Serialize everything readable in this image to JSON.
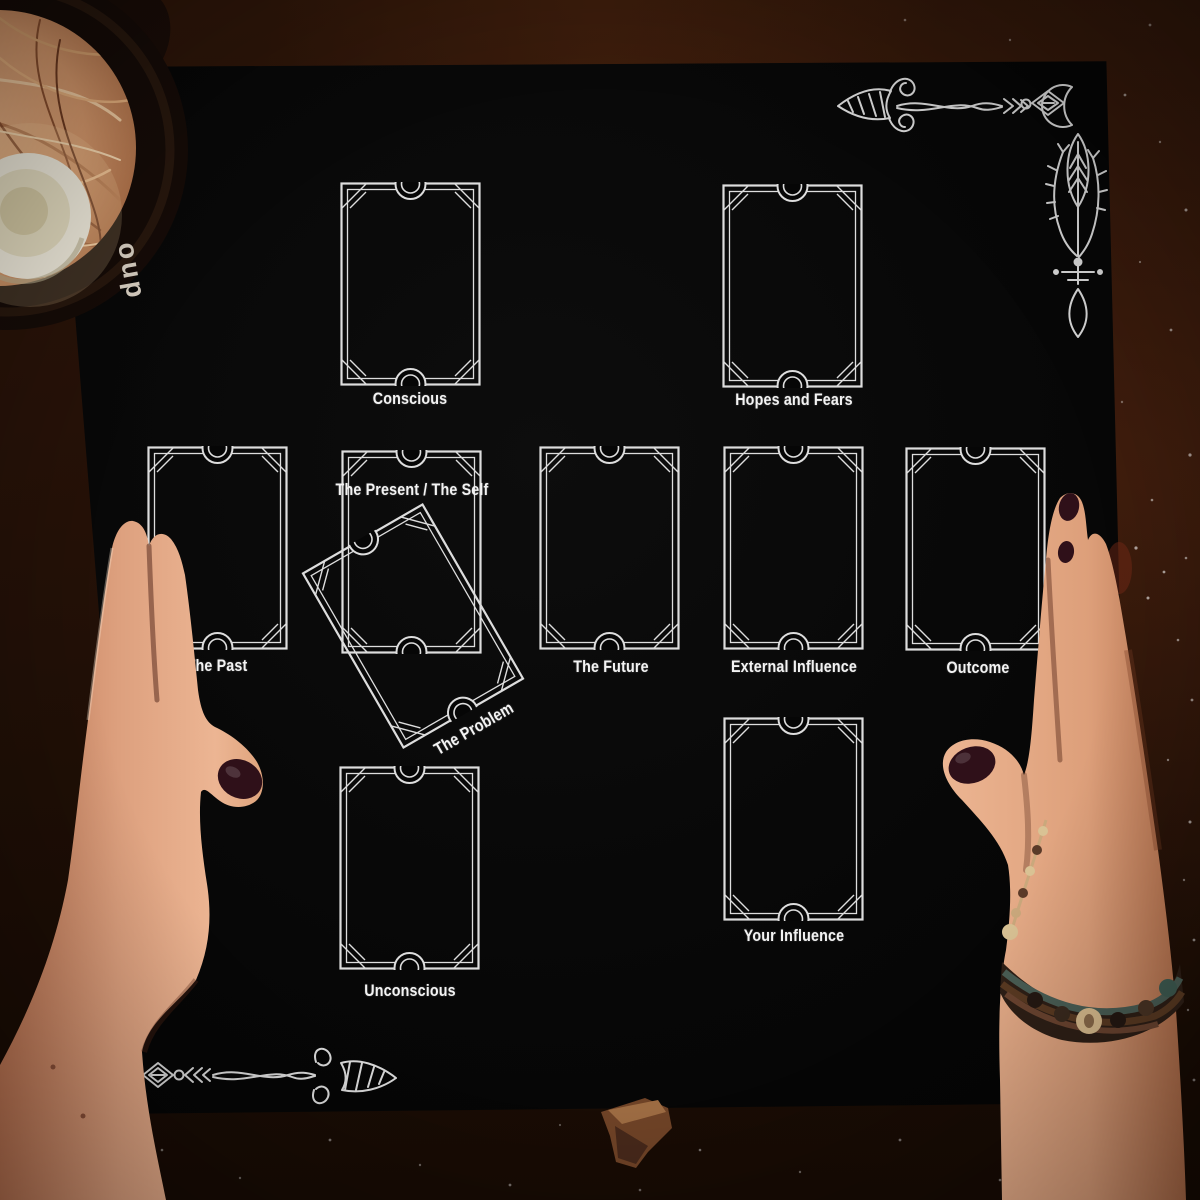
{
  "spread": {
    "positions": [
      {
        "id": "conscious",
        "label": "Conscious"
      },
      {
        "id": "hopes-and-fears",
        "label": "Hopes and Fears"
      },
      {
        "id": "the-past",
        "label": "The Past"
      },
      {
        "id": "the-present-the-self",
        "label": "The Present / The Self"
      },
      {
        "id": "the-problem",
        "label": "The Problem"
      },
      {
        "id": "the-future",
        "label": "The Future"
      },
      {
        "id": "external-influence",
        "label": "External Influence"
      },
      {
        "id": "outcome",
        "label": "Outcome"
      },
      {
        "id": "unconscious",
        "label": "Unconscious"
      },
      {
        "id": "your-influence",
        "label": "Your Influence"
      }
    ]
  },
  "objects": {
    "pot_label": "oup"
  },
  "colors": {
    "cloth": "#070707",
    "print": "#f3f3f3",
    "wood_top": "#2a1409",
    "wood_right": "#2f1810",
    "wood_bottom": "#1c0d06",
    "skin": "#dfa182",
    "nail_polish": "#2f1019",
    "candle": "#efe9d8",
    "straw": "#d7996c"
  }
}
